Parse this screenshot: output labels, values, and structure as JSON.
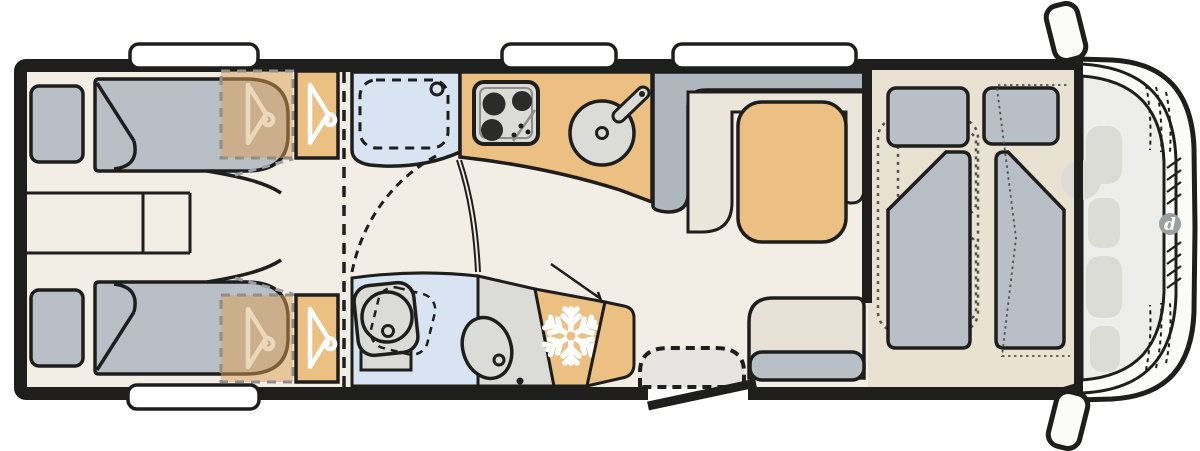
{
  "page": {
    "background": "#ffffff"
  },
  "floorplan": {
    "kind": "motorhome-floor-plan",
    "orientation": "rear-left-front-right",
    "areas": [
      "rear-twin-single-beds",
      "wardrobes-with-hangers",
      "shower-cubicle",
      "kitchen-block",
      "washroom-toilet-basin",
      "fridge",
      "l-shaped-dinette-with-table",
      "rear-bench-seat",
      "entrance-door-with-step",
      "drop-down-bed-over-cab",
      "driver-cab-front"
    ],
    "icons": [
      "hanger-icon",
      "snowflake-icon",
      "hob-3-burner-icon",
      "round-sink-icon",
      "toilet-icon",
      "washbasin-icon",
      "wing-mirror-icon",
      "headlight-icon",
      "manufacturer-logo"
    ]
  },
  "nose": {
    "logo_letter": "d"
  },
  "colors": {
    "wall": "#1e1e1c",
    "floor": "#f3eee5",
    "floor_cab": "#e9e1d2",
    "orange": "#ecc083",
    "orange_overlay": "rgba(222,158,82,0.5)",
    "grey": "#b9bfc7",
    "grey_dark": "#b0b6bd",
    "light_grey": "#dbdbd8",
    "blue": "#d8e4f2",
    "white": "#ffffff",
    "seat_beige": "#ece6da",
    "bench_beige": "#e7e1d6",
    "step_grey": "#e6e4e0",
    "nose": "#fbfbfa",
    "cab_interior": "#ededeb",
    "faded": "#dcdcd7",
    "logo_grey": "#9aa0a2",
    "burner": "#2b2b29",
    "hanger_faded": "#ead9ba",
    "dash_grey": "#9aa0a6",
    "inner_grey": "#8d8d89",
    "overlay_dash": "#8e8e8a",
    "dot_grey": "#55524e"
  }
}
